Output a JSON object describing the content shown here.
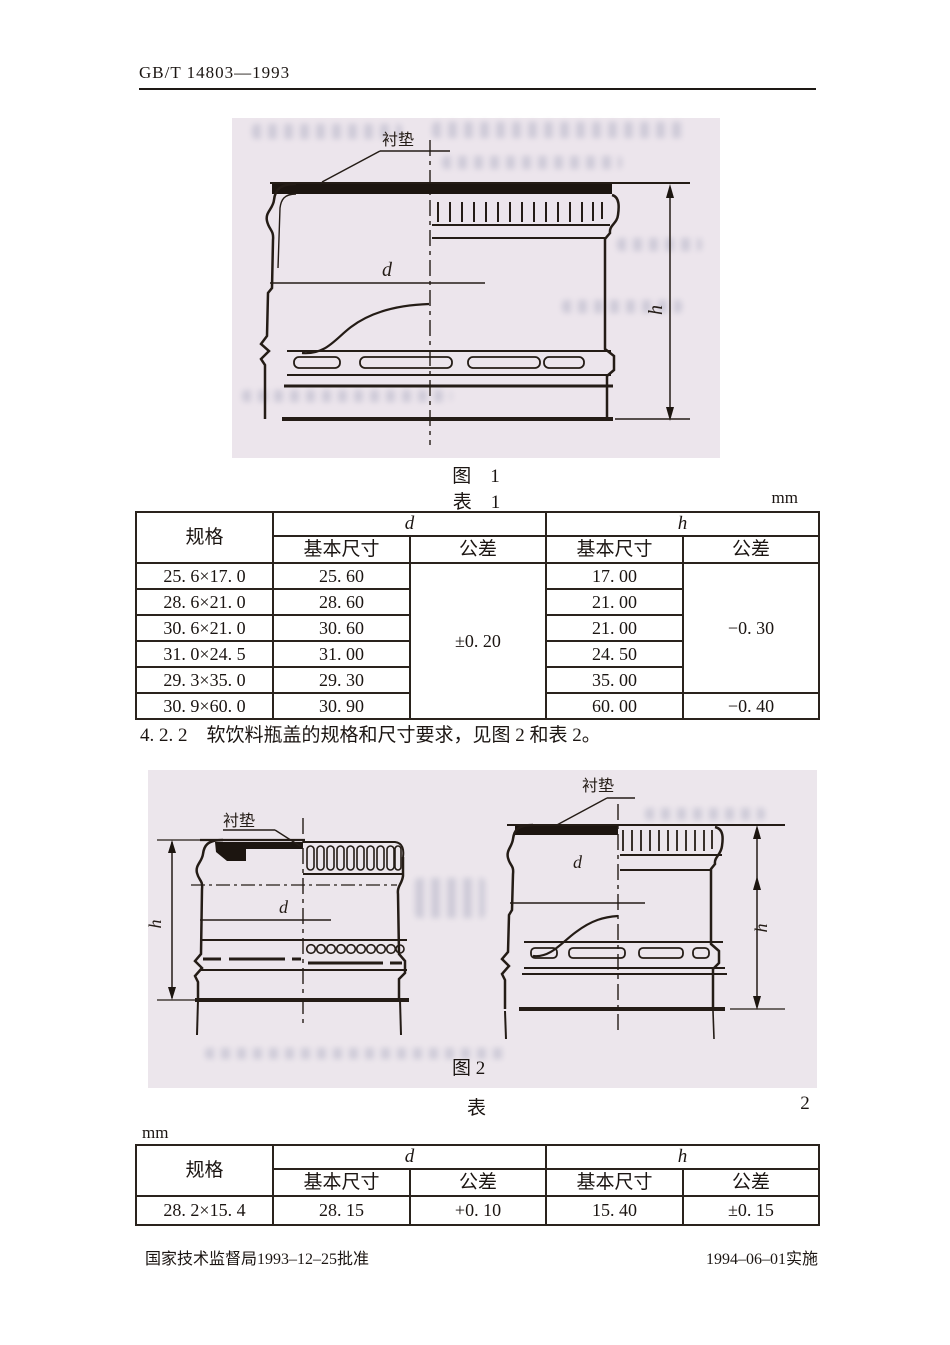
{
  "header": {
    "doc_number": "GB/T 14803—1993"
  },
  "figure1": {
    "caption": "图　1",
    "liner_label": "衬垫",
    "dim_d": "d",
    "dim_h": "h"
  },
  "table1": {
    "caption": "表　1",
    "unit": "mm",
    "headers": {
      "spec": "规格",
      "d": "d",
      "h": "h",
      "basic": "基本尺寸",
      "tolerance": "公差"
    },
    "rows": [
      {
        "spec": "25. 6×17. 0",
        "d_basic": "25. 60",
        "h_basic": "17. 00"
      },
      {
        "spec": "28. 6×21. 0",
        "d_basic": "28. 60",
        "h_basic": "21. 00"
      },
      {
        "spec": "30. 6×21. 0",
        "d_basic": "30. 60",
        "h_basic": "21. 00"
      },
      {
        "spec": "31. 0×24. 5",
        "d_basic": "31. 00",
        "h_basic": "24. 50"
      },
      {
        "spec": "29. 3×35. 0",
        "d_basic": "29. 30",
        "h_basic": "35. 00"
      },
      {
        "spec": "30. 9×60. 0",
        "d_basic": "30. 90",
        "h_basic": "60. 00"
      }
    ],
    "d_tolerance": "±0. 20",
    "h_tolerance_rows_1_5": "−0. 30",
    "h_tolerance_row_6": "−0. 40"
  },
  "section_4_2_2": "4. 2. 2　软饮料瓶盖的规格和尺寸要求，见图 2 和表 2。",
  "figure2": {
    "caption": "图 2",
    "left": {
      "liner_label": "衬垫",
      "dim_d": "d",
      "dim_h": "h"
    },
    "right": {
      "liner_label": "衬垫",
      "dim_d": "d",
      "dim_h": "h"
    }
  },
  "table2": {
    "caption_label": "表",
    "caption_number": "2",
    "unit": "mm",
    "headers": {
      "spec": "规格",
      "d": "d",
      "h": "h",
      "basic": "基本尺寸",
      "tolerance": "公差"
    },
    "rows": [
      {
        "spec": "28. 2×15. 4",
        "d_basic": "28. 15",
        "d_tolerance": "+0. 10",
        "h_basic": "15. 40",
        "h_tolerance": "±0. 15"
      }
    ]
  },
  "footer": {
    "approval": "国家技术监督局1993–12–25批准",
    "implementation": "1994–06–01实施"
  }
}
